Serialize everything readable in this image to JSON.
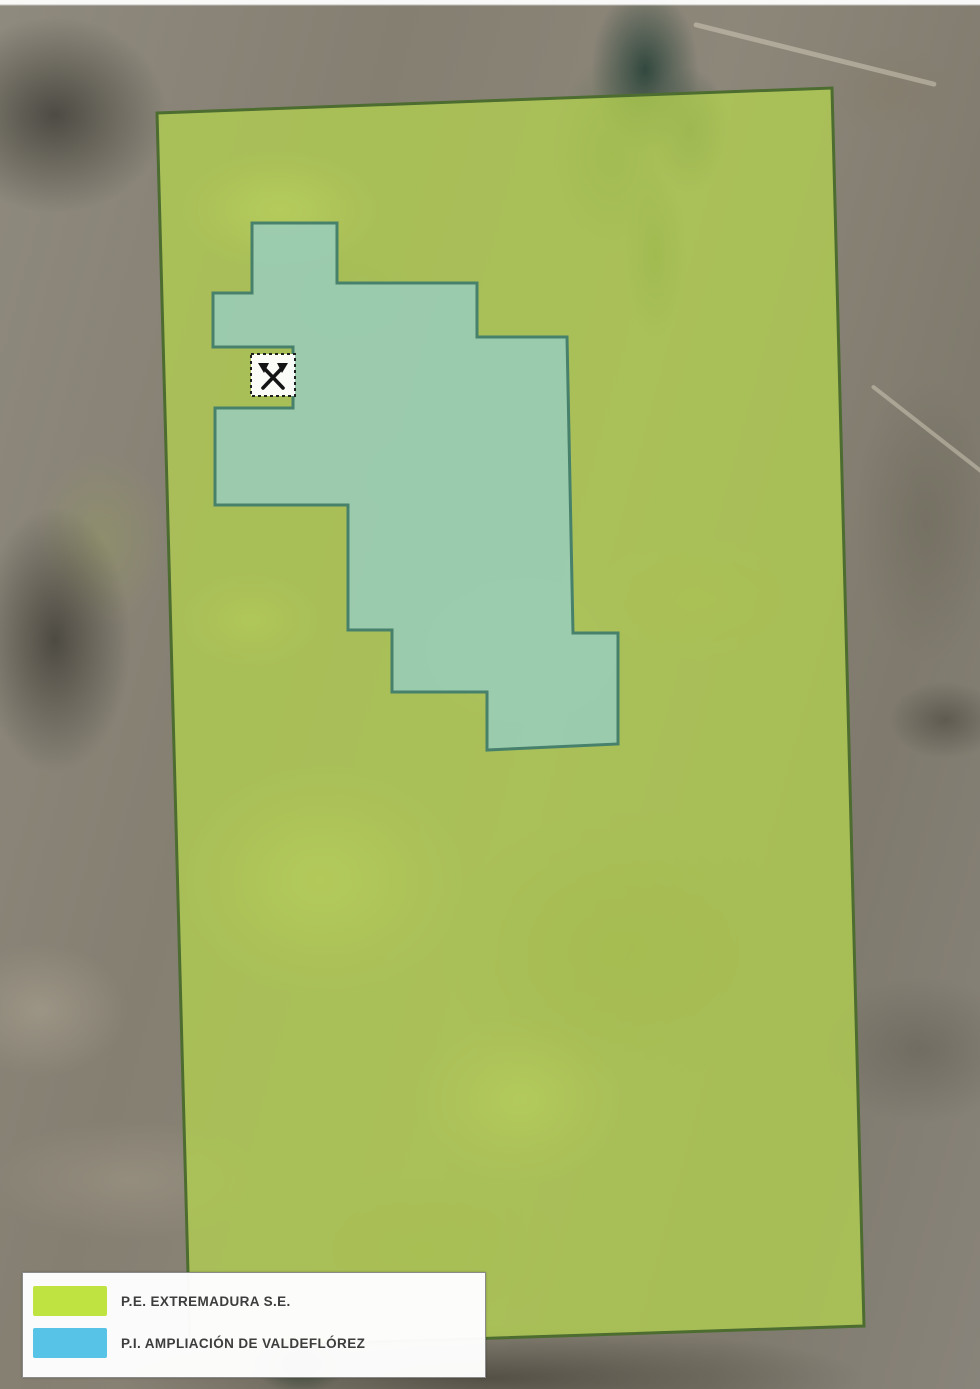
{
  "legend": {
    "items": [
      {
        "name": "pe-extremadura",
        "label": "P.E. EXTREMADURA S.E.",
        "color": "#bfe442"
      },
      {
        "name": "pi-ampliacion-valdeflorez",
        "label": "P.I. AMPLIACIÓN DE VALDEFLÓREZ",
        "color": "#57c3e6"
      }
    ]
  },
  "map": {
    "green_area": {
      "label": "P.E. EXTREMADURA S.E.",
      "points": "157,113 832,88 864,1326 190,1348",
      "fill": "rgba(178,208,80,0.78)",
      "stroke": "#4c6c30"
    },
    "blue_area": {
      "label": "P.I. AMPLIACIÓN DE VALDEFLÓREZ",
      "points": "252,223 337,223 337,283 477,283 477,337 567,337 573,633 618,633 618,744 487,750 487,692 392,692 392,630 348,630 348,505 215,505 215,408 293,408 293,347 213,347 213,293 252,293",
      "fill": "rgba(152,205,184,0.88)",
      "stroke": "#47816c"
    },
    "marker": {
      "symbol": "crossed-hammers",
      "fill": "#ffffff",
      "stroke": "#1a1a1a"
    }
  }
}
